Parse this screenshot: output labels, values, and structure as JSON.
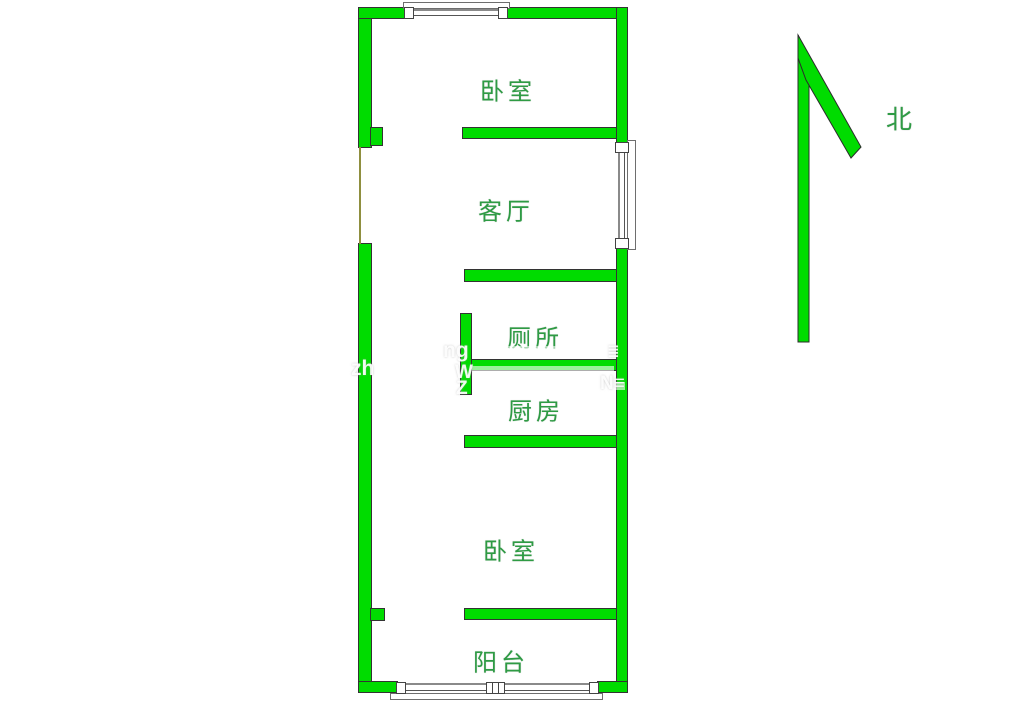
{
  "title": "apartment-floor-plan",
  "north": {
    "label": "北"
  },
  "rooms": [
    {
      "id": "bedroom-top",
      "label": "卧室"
    },
    {
      "id": "living-room",
      "label": "客厅"
    },
    {
      "id": "toilet",
      "label": "厕所"
    },
    {
      "id": "kitchen",
      "label": "厨房"
    },
    {
      "id": "bedroom-bottom",
      "label": "卧室"
    },
    {
      "id": "balcony",
      "label": "阳台"
    }
  ],
  "watermark": {
    "fragments": [
      {
        "text": "zh"
      },
      {
        "text": "ng"
      },
      {
        "text": "W"
      },
      {
        "text": "Z"
      },
      {
        "text": "N≡"
      },
      {
        "text": "≣"
      }
    ]
  },
  "colors": {
    "wall_green": "#00DC00",
    "wall_outline": "#333333",
    "label_green": "#2E9B44",
    "window_gray": "#6E6E6E",
    "door_gap_olive": "#8F8F3F",
    "background": "#FFFFFF"
  }
}
